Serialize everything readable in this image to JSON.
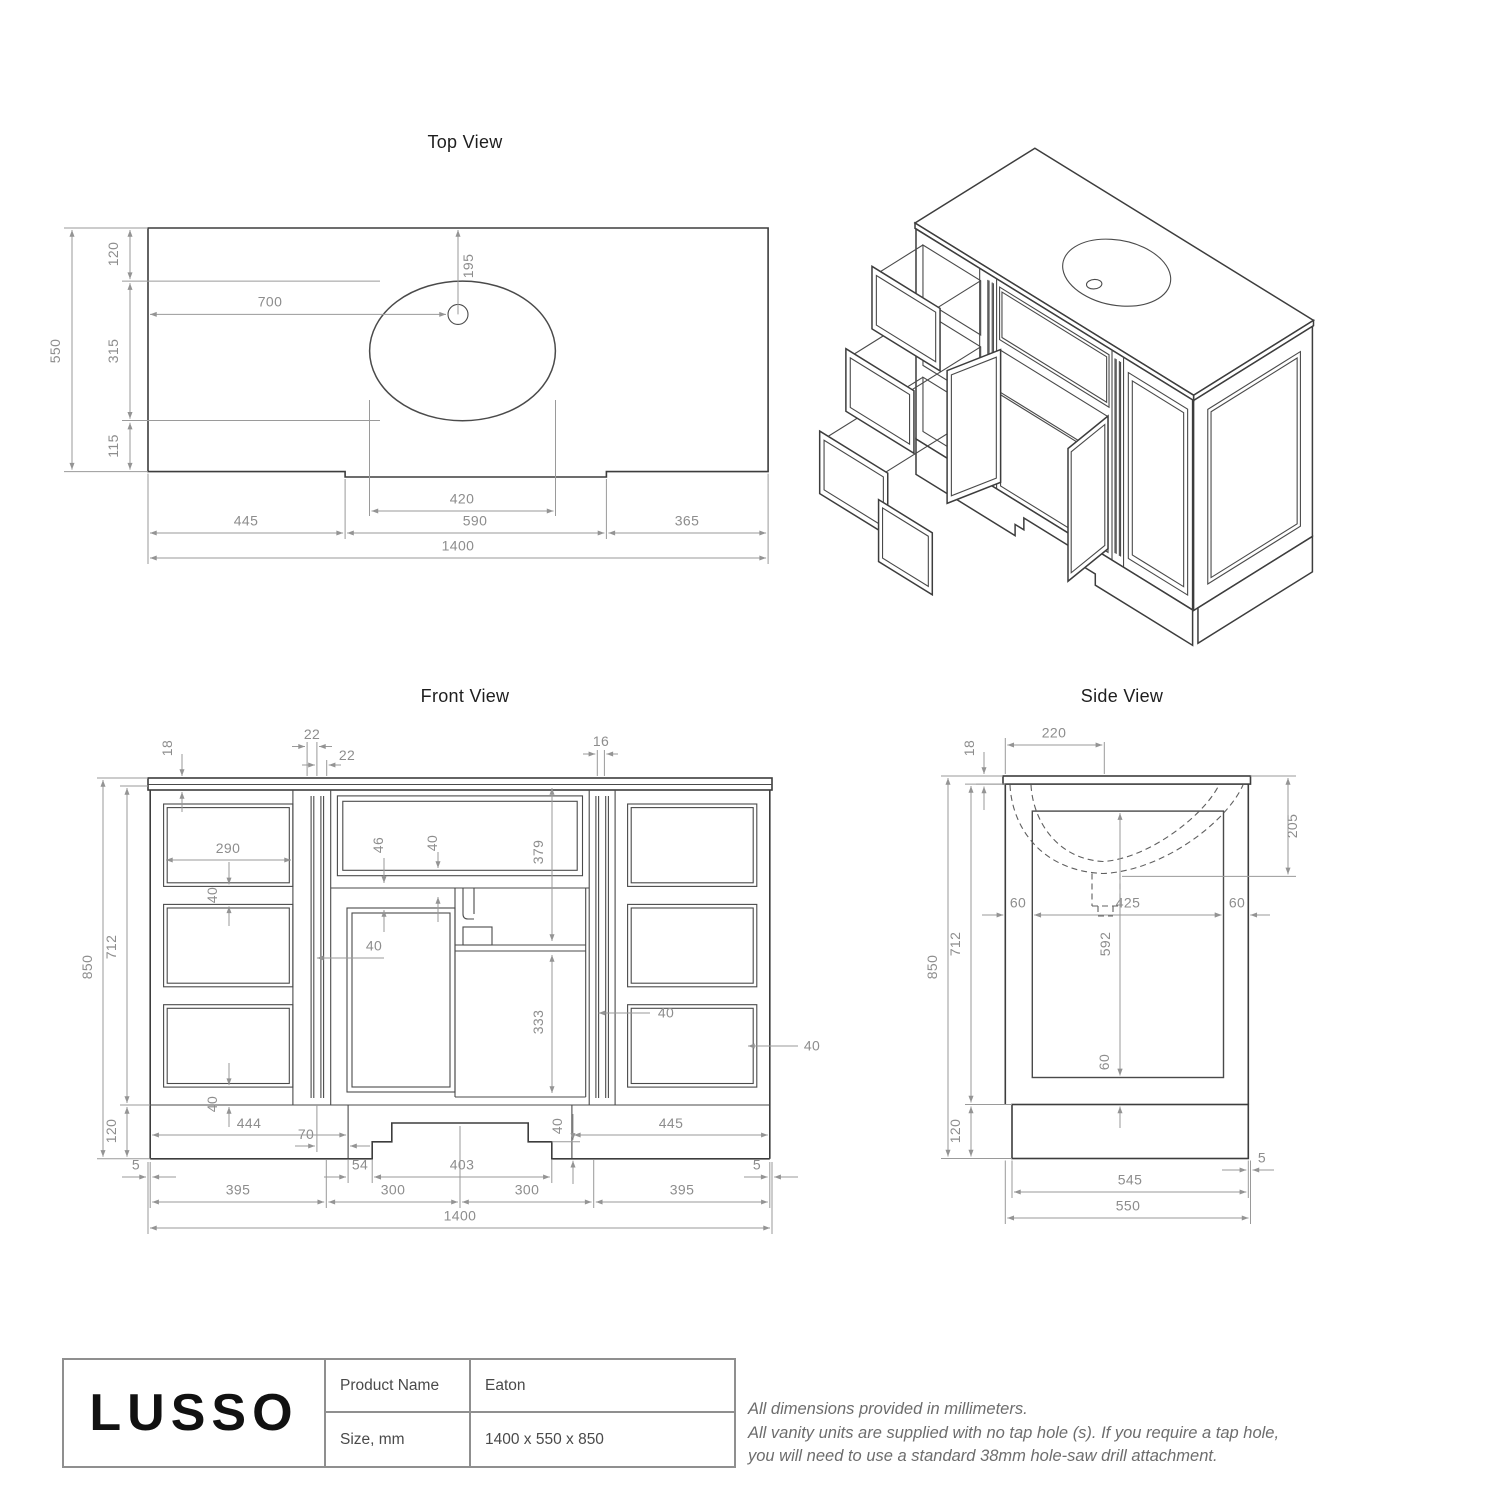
{
  "views": {
    "top": {
      "title": "Top View",
      "dims": {
        "d550": "550",
        "d120": "120",
        "d315": "315",
        "d115": "115",
        "d700": "700",
        "d195": "195",
        "d420": "420",
        "d445": "445",
        "d590": "590",
        "d365": "365",
        "d1400": "1400"
      }
    },
    "front": {
      "title": "Front View",
      "dims": {
        "d18": "18",
        "d22a": "22",
        "d22b": "22",
        "d16": "16",
        "d290": "290",
        "d40a": "40",
        "d40b": "40",
        "d46": "46",
        "d40c": "40",
        "d379": "379",
        "d40d": "40",
        "d40e": "40",
        "d40f": "40",
        "d40g": "40",
        "d850": "850",
        "d712": "712",
        "d120": "120",
        "d333": "333",
        "d70": "70",
        "d444": "444",
        "d445": "445",
        "d5a": "5",
        "d54": "54",
        "d403": "403",
        "d300a": "300",
        "d300b": "300",
        "d395a": "395",
        "d395b": "395",
        "d5b": "5",
        "d1400": "1400"
      }
    },
    "side": {
      "title": "Side View",
      "dims": {
        "d18": "18",
        "d220": "220",
        "d205": "205",
        "d850": "850",
        "d712": "712",
        "d120": "120",
        "d60a": "60",
        "d425": "425",
        "d60b": "60",
        "d592": "592",
        "d60c": "60",
        "d545": "545",
        "d5": "5",
        "d550": "550"
      }
    }
  },
  "title_block": {
    "brand": "LUSSO",
    "rows": [
      {
        "label": "Product Name",
        "value": "Eaton"
      },
      {
        "label": "Size, mm",
        "value": "1400 x 550 x 850"
      }
    ]
  },
  "notes": [
    "All dimensions provided in millimeters.",
    "All vanity units are supplied with no tap hole (s). If you require a tap hole,",
    "you will need to use a standard 38mm hole-saw drill attachment."
  ]
}
